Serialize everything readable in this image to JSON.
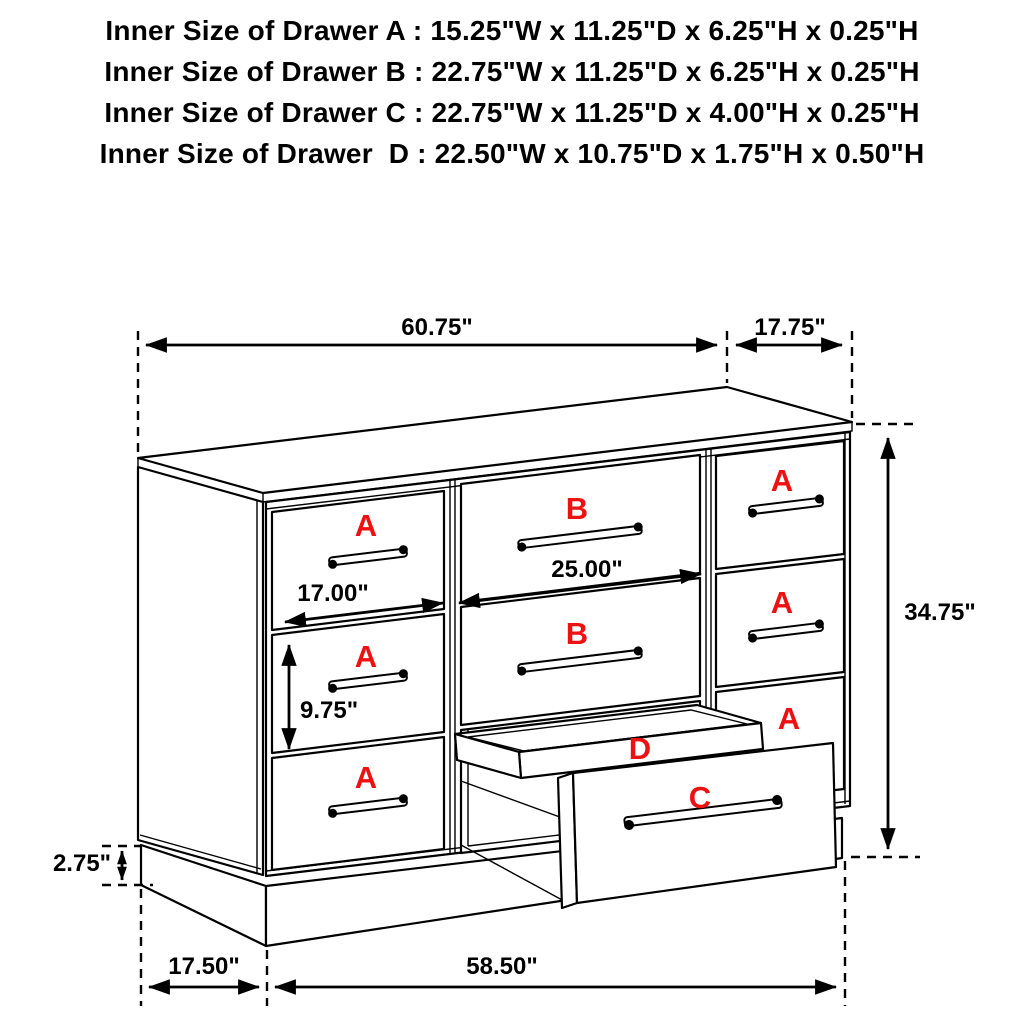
{
  "header": {
    "lines": [
      "Inner Size of Drawer A : 15.25\"W x 11.25\"D x 6.25\"H x 0.25\"H",
      "Inner Size of Drawer B : 22.75\"W x 11.25\"D x 6.25\"H x 0.25\"H",
      "Inner Size of Drawer C : 22.75\"W x 11.25\"D x 4.00\"H x 0.25\"H",
      "Inner Size of Drawer  D : 22.50\"W x 10.75\"D x 1.75\"H x 0.50\"H"
    ]
  },
  "diagram": {
    "type": "dresser-dimension-line-drawing",
    "drawer_letters": {
      "a": "A",
      "b": "B",
      "c": "C",
      "d": "D"
    },
    "dimensions": {
      "top_width": "60.75\"",
      "top_depth": "17.75\"",
      "overall_height": "34.75\"",
      "left_drawer_width": "17.00\"",
      "middle_drawer_width": "25.00\"",
      "drawer_height": "9.75\"",
      "base_height": "2.75\"",
      "base_side_depth": "17.50\"",
      "base_front_width": "58.50\""
    },
    "colors": {
      "label_red": "#ee1111",
      "line_black": "#000000",
      "background": "#ffffff"
    }
  }
}
